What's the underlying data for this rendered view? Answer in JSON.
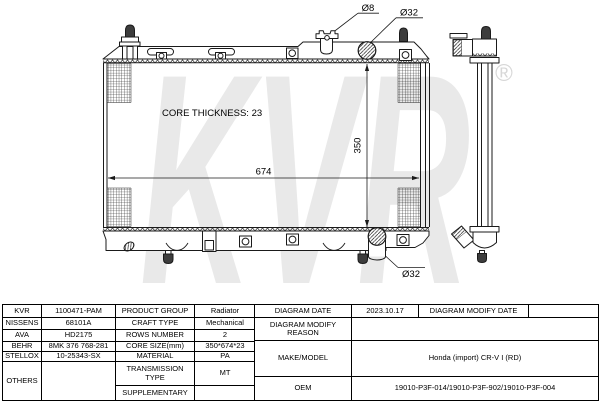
{
  "drawing": {
    "watermark_text": "KVR",
    "registered_symbol": "®",
    "core_thickness_label": "CORE THICKNESS: 23",
    "dim_width": "674",
    "dim_height": "350",
    "label_cap_dia": "Ø8",
    "label_inlet_dia": "Ø32",
    "label_outlet_dia": "Ø32"
  },
  "table": {
    "brands": [
      {
        "brand": "KVR",
        "code": "1100471-PAM"
      },
      {
        "brand": "NISSENS",
        "code": "68101A"
      },
      {
        "brand": "AVA",
        "code": "HD2175"
      },
      {
        "brand": "BEHR",
        "code": "8MK 376 768-281"
      },
      {
        "brand": "STELLOX",
        "code": "10-25343-SX"
      },
      {
        "brand": "OTHERS",
        "code": ""
      }
    ],
    "specs": [
      {
        "label": "PRODUCT GROUP",
        "value": "Radiator"
      },
      {
        "label": "CRAFT TYPE",
        "value": "Mechanical"
      },
      {
        "label": "ROWS NUMBER",
        "value": "2"
      },
      {
        "label": "CORE SIZE(mm)",
        "value": "350*674*23"
      },
      {
        "label": "MATERIAL",
        "value": "PA"
      },
      {
        "label": "TRANSMISSION TYPE",
        "value": "MT"
      },
      {
        "label": "SUPPLEMENTARY",
        "value": ""
      }
    ],
    "right": {
      "diagram_date_label": "DIAGRAM DATE",
      "diagram_date_value": "2023.10.17",
      "diagram_modify_date_label": "DIAGRAM MODIFY DATE",
      "diagram_modify_date_value": "",
      "diagram_modify_reason_label": "DIAGRAM MODIFY REASON",
      "diagram_modify_reason_value": "",
      "make_model_label": "MAKE/MODEL",
      "make_model_value": "Honda (import) CR-V I (RD)",
      "oem_label": "OEM",
      "oem_value": "19010-P3F-014/19010-P3F-902/19010-P3F-004"
    }
  }
}
